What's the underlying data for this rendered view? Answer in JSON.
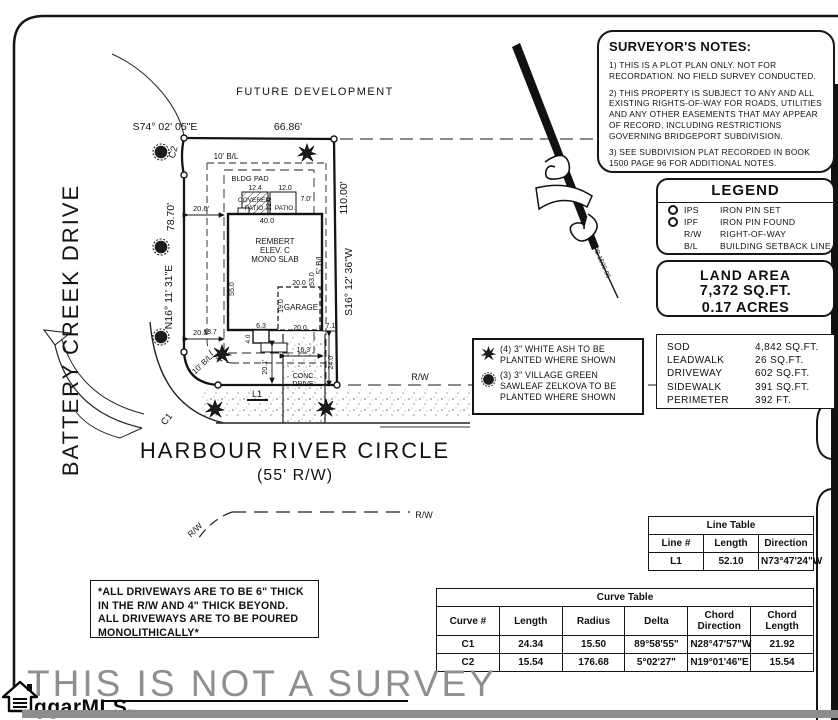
{
  "notes_box": {
    "title": "SURVEYOR'S NOTES:",
    "items": [
      "1) THIS IS A PLOT PLAN ONLY. NOT FOR RECORDATION. NO FIELD SURVEY CONDUCTED.",
      "2) THIS PROPERTY IS SUBJECT TO ANY AND ALL EXISTING RIGHTS-OF-WAY FOR ROADS, UTILITIES AND ANY OTHER EASEMENTS THAT MAY APPEAR OF RECORD, INCLUDING RESTRICTIONS GOVERNING BRIDGEPORT SUBDIVISION.",
      "3) SEE SUBDIVISION PLAT RECORDED IN BOOK 1500 PAGE 96 FOR ADDITIONAL NOTES."
    ]
  },
  "legend": {
    "title": "LEGEND",
    "rows": [
      {
        "abbr": "IPS",
        "desc": "IRON PIN SET"
      },
      {
        "abbr": "IPF",
        "desc": "IRON PIN FOUND"
      },
      {
        "abbr": "R/W",
        "desc": "RIGHT-OF-WAY"
      },
      {
        "abbr": "B/L",
        "desc": "BUILDING SETBACK LINE"
      }
    ]
  },
  "land_area": {
    "title": "LAND AREA",
    "sqft": "7,372 SQ.FT.",
    "acres": "0.17 ACRES"
  },
  "areas": {
    "rows": [
      [
        "SOD",
        "4,842 SQ.FT."
      ],
      [
        "LEADWALK",
        "26 SQ.FT."
      ],
      [
        "DRIVEWAY",
        "602 SQ.FT."
      ],
      [
        "SIDEWALK",
        "391 SQ.FT."
      ],
      [
        "PERIMETER",
        "392 FT."
      ]
    ]
  },
  "planting": {
    "ash": "(4) 3\" WHITE ASH TO BE PLANTED WHERE SHOWN",
    "zelkova": "(3) 3\" VILLAGE GREEN SAWLEAF ZELKOVA TO BE PLANTED WHERE SHOWN"
  },
  "driveway_note": "*ALL DRIVEWAYS ARE TO BE 6\" THICK IN THE R/W AND 4\" THICK BEYOND. ALL DRIVEWAYS ARE TO BE POURED MONOLITHICALLY*",
  "line_table": {
    "title": "Line Table",
    "headers": [
      "Line #",
      "Length",
      "Direction"
    ],
    "rows": [
      [
        "L1",
        "52.10",
        "N73°47'24\"W"
      ]
    ]
  },
  "curve_table": {
    "title": "Curve Table",
    "headers": [
      "Curve #",
      "Length",
      "Radius",
      "Delta",
      "Chord Direction",
      "Chord Length"
    ],
    "rows": [
      [
        "C1",
        "24.34",
        "15.50",
        "89°58'55\"",
        "N28°47'57\"W",
        "21.92"
      ],
      [
        "C2",
        "15.54",
        "176.68",
        "5°02'27\"",
        "N19°01'46\"E",
        "15.54"
      ]
    ]
  },
  "watermark": "THIS IS NOT A SURVEY",
  "logo": {
    "text": "ggarMLS",
    "tm": "™"
  },
  "plan": {
    "future_development": "FUTURE DEVELOPMENT",
    "street1": "BATTERY CREEK DRIVE",
    "top_bearing": "S74° 02' 05\"E",
    "top_distance": "66.86'",
    "west_distance": "78.70'",
    "west_bearing": "N16° 11' 31\"E",
    "east_distance": "110.00'",
    "east_bearing": "S16° 12' 36\"W",
    "c1": "C1",
    "c2": "C2",
    "l1": "L1",
    "rw": "R/W",
    "bl10": "10' B/L",
    "bl5": "5' B/L",
    "bldg_pad": "BLDG PAD",
    "covered1": "COVERED",
    "covered2": "PATIO",
    "patio": "PATIO.",
    "dim_124": "12.4",
    "dim_120": "12.0",
    "dim_120v": "12.0",
    "dim_70": "7.0'",
    "dim_400": "40.0",
    "house_name": "REMBERT",
    "house_elev": "ELEV. C",
    "house_slab": "MONO SLAB",
    "dim_550": "55.0",
    "dim_530": "53.0",
    "garage": "GARAGE",
    "dim_200_top": "20.0",
    "dim_190": "19.0",
    "dim_200_front": "20.0",
    "dim_137": "13.7",
    "dim_40": "4.0",
    "dim_63": "6.3",
    "dim_71": "7.1'",
    "dim_206": "20.6'",
    "dim_205": "20.5'",
    "dim_201": "20.1'",
    "dim_163": "16.3'",
    "dim_240": "24.0'",
    "conc1": "CONC.",
    "conc2": "DRIVE.",
    "street_name": "HARBOUR RIVER CIRCLE",
    "street_rw": "(55' R/W)",
    "pb": "PB 1500-96"
  }
}
